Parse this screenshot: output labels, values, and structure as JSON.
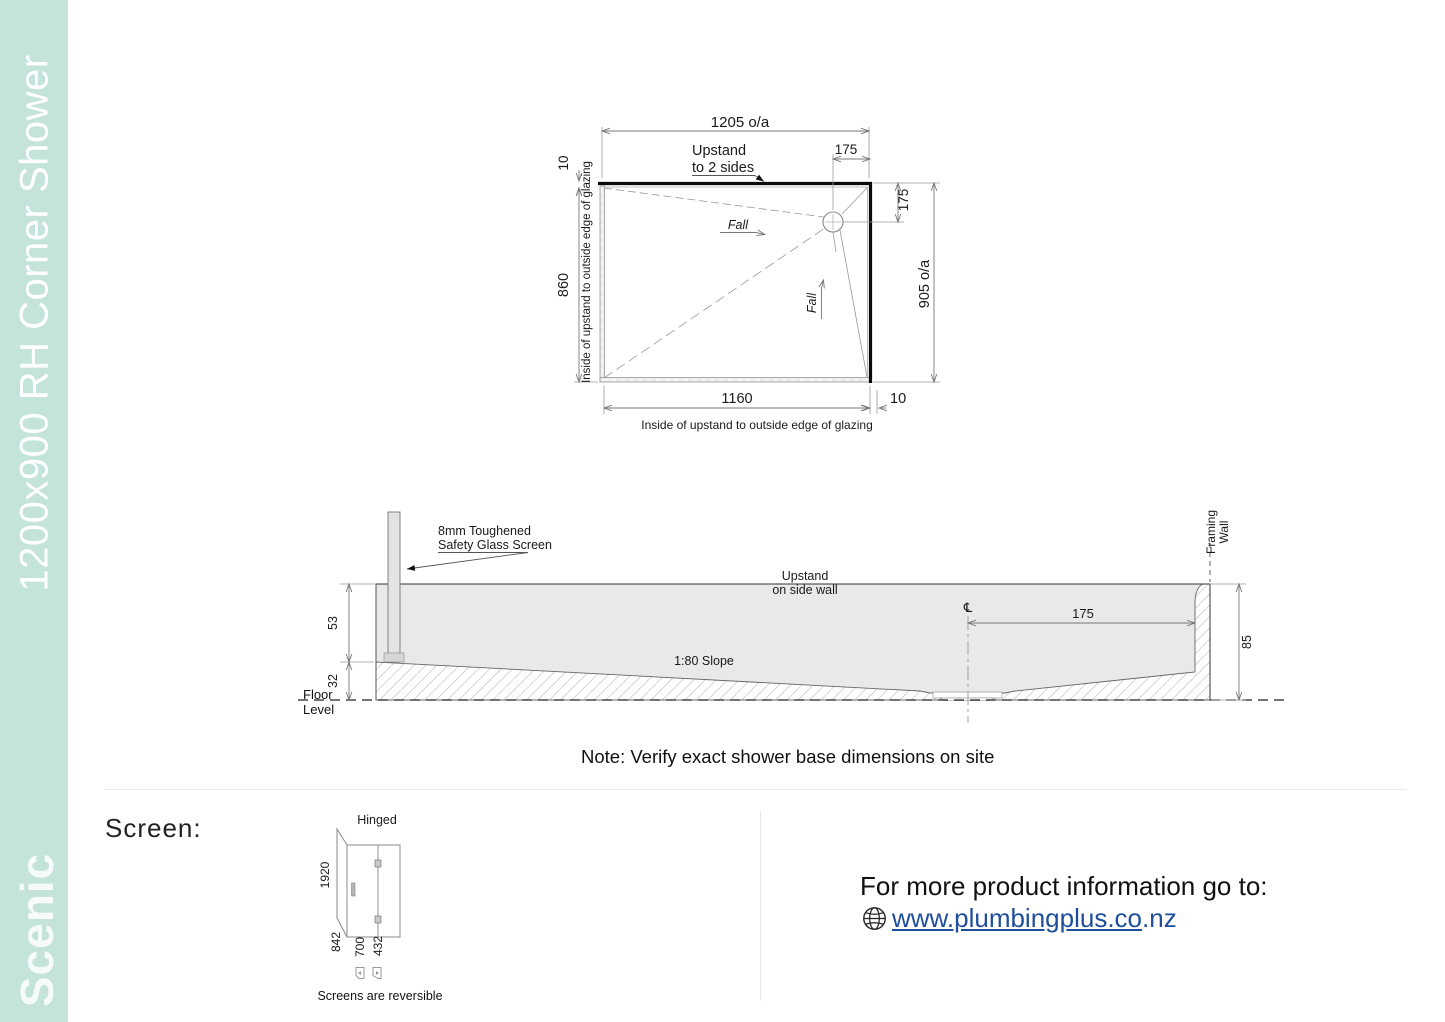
{
  "sidebar": {
    "title": "1200x900 RH Corner Shower",
    "brand": "Scenic"
  },
  "plan": {
    "dim_overall_width": "1205 o/a",
    "dim_drain_offset_top": "175",
    "dim_drain_offset_right": "175",
    "dim_overall_depth": "905 o/a",
    "dim_glazing_top": "10",
    "dim_inside_depth": "860",
    "dim_inside_width": "1160",
    "dim_glazing_right": "10",
    "upstand_line1": "Upstand",
    "upstand_line2": "to 2 sides",
    "left_label": "Inside of upstand to outside edge of glazing",
    "bottom_label": "Inside of upstand to outside edge of glazing",
    "fall_label1": "Fall",
    "fall_label2": "Fall"
  },
  "section": {
    "glass_line1": "8mm Toughened",
    "glass_line2": "Safety Glass Screen",
    "upstand_line1": "Upstand",
    "upstand_line2": "on side wall",
    "slope_label": "1:80 Slope",
    "dim_upstand_height": "53",
    "dim_base_height": "32",
    "dim_total_height": "85",
    "dim_drain_offset": "175",
    "centerline_symbol": "℄",
    "floor_label": "Floor Level",
    "framing_line1": "Framing",
    "framing_line2": "Wall"
  },
  "note": "Note: Verify exact shower base dimensions on site",
  "screen": {
    "heading": "Screen:",
    "hinged_label": "Hinged",
    "dim_height": "1920",
    "dim_return_width": "842",
    "dim_door_width": "700",
    "dim_fixed_width": "432",
    "reversible_label": "Screens are reversible"
  },
  "info": {
    "text": "For more product information go to:",
    "link_text": "www.plumbingplus.co",
    "link_suffix": ".nz"
  },
  "colors": {
    "sidebar_bg": "#c3e3db",
    "link": "#1f4e9c",
    "section_fill": "#e9e9e9"
  }
}
